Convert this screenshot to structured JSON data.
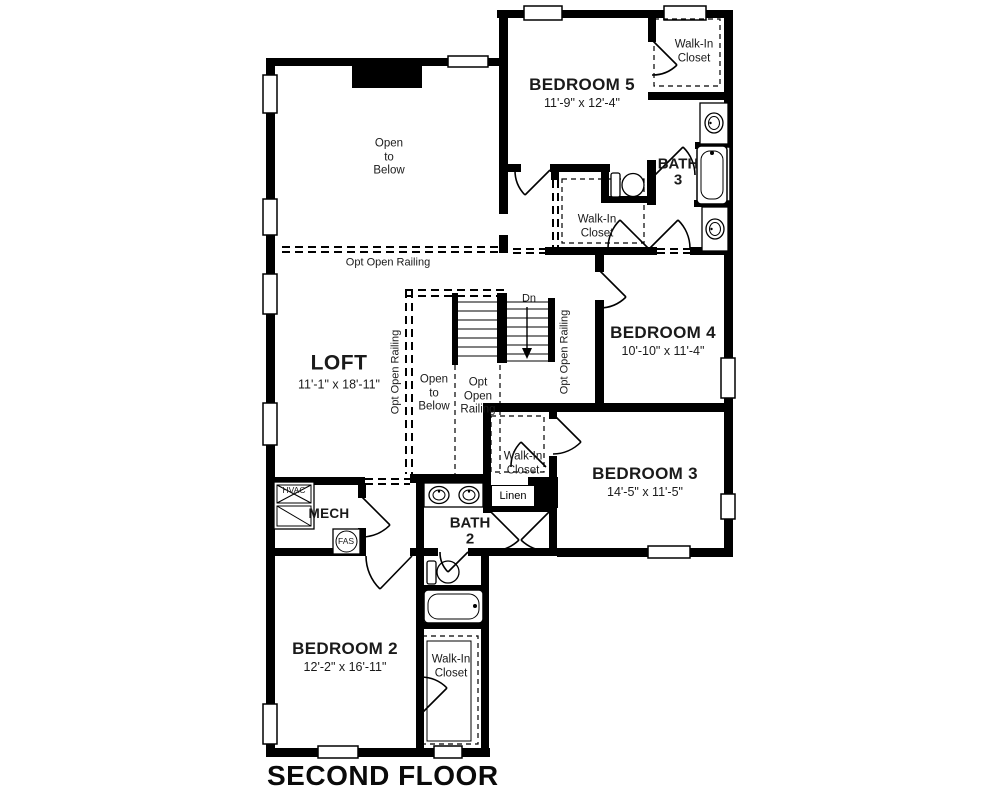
{
  "page_title": "SECOND FLOOR",
  "rooms": {
    "bedroom5": {
      "name": "BEDROOM 5",
      "dims": "11'-9\" x 12'-4\""
    },
    "bedroom4": {
      "name": "BEDROOM 4",
      "dims": "10'-10\" x 11'-4\""
    },
    "bedroom3": {
      "name": "BEDROOM 3",
      "dims": "14'-5\" x 11'-5\""
    },
    "bedroom2": {
      "name": "BEDROOM 2",
      "dims": "12'-2\" x 16'-11\""
    },
    "loft": {
      "name": "LOFT",
      "dims": "11'-1\" x 18'-11\""
    },
    "bath3": {
      "name": "BATH",
      "num": "3"
    },
    "bath2": {
      "name": "BATH",
      "num": "2"
    },
    "mech": {
      "name": "MECH"
    }
  },
  "labels": {
    "walk_in_l1": "Walk-In",
    "walk_in_l2": "Closet",
    "open_l1": "Open",
    "open_l2": "to",
    "open_l3": "Below",
    "opt_open_railing": "Opt Open Railing",
    "opt": "Opt",
    "open": "Open",
    "railing": "Railing",
    "linen": "Linen",
    "dn": "Dn",
    "hvac": "HVAC",
    "fas": "FAS"
  }
}
